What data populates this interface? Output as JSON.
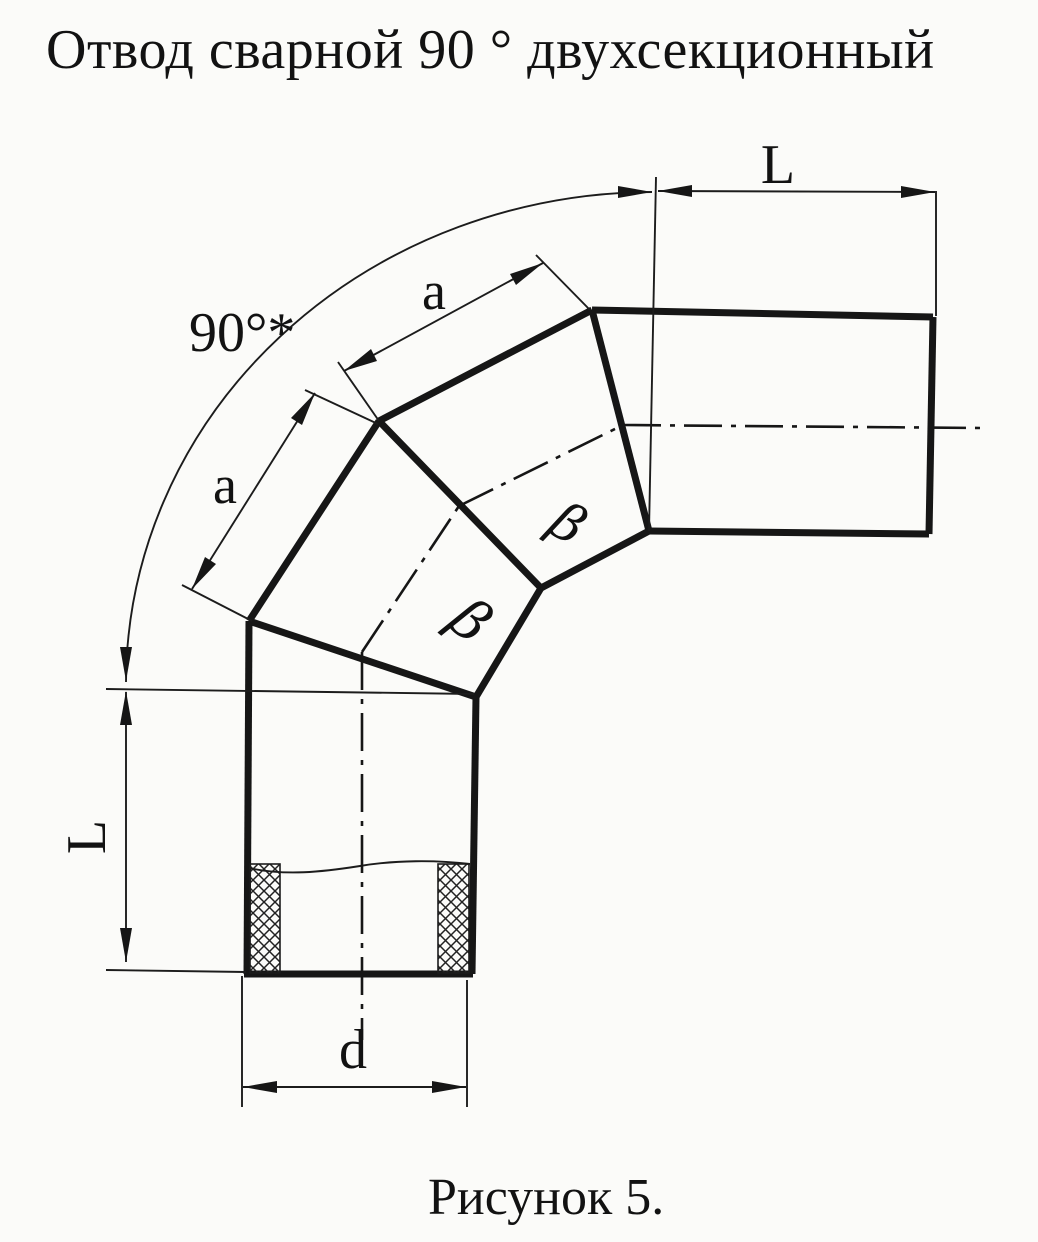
{
  "title": "Отвод сварной 90 ° двухсекционный",
  "caption": "Рисунок 5.",
  "labels": {
    "angle": "90°*",
    "length_top": "L",
    "length_left": "L",
    "segment_upper": "a",
    "segment_lower": "a",
    "diameter": "d",
    "bevel_upper": "β",
    "bevel_lower": "β"
  },
  "colors": {
    "ink": "#161616",
    "paper": "#fbfbf9"
  }
}
